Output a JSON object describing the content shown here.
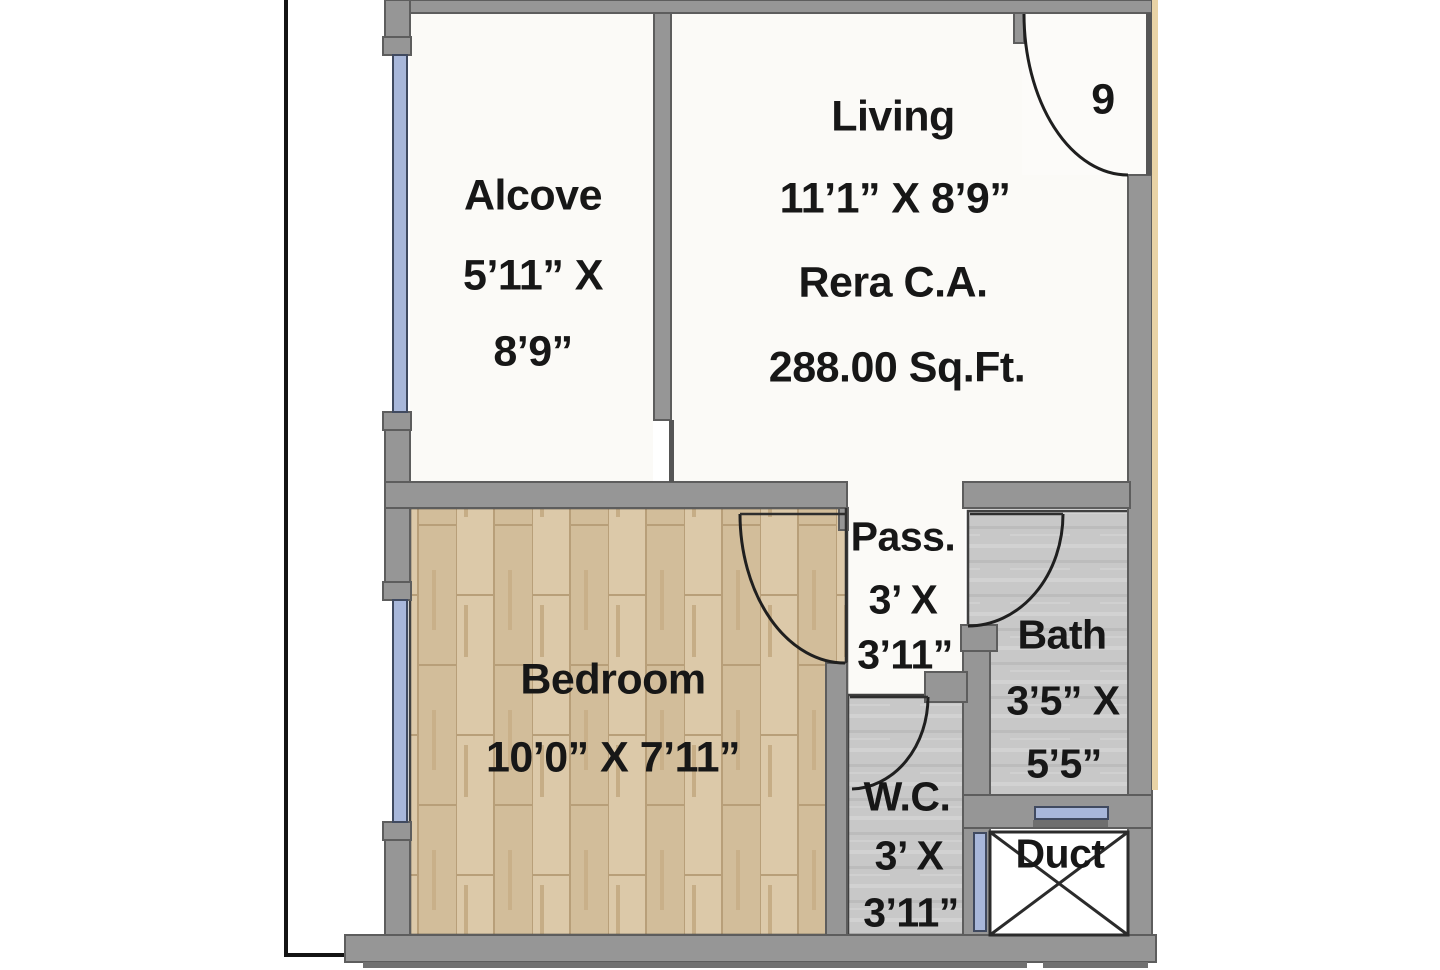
{
  "flat_number": "9",
  "rooms": {
    "alcove": {
      "name": "Alcove",
      "dim1": "5’11” X",
      "dim2": "8’9”"
    },
    "living": {
      "name": "Living",
      "dim": "11’1” X 8’9”",
      "rera": "Rera C.A.",
      "area": "288.00 Sq.Ft."
    },
    "bedroom": {
      "name": "Bedroom",
      "dim": "10’0” X 7’11”"
    },
    "pass": {
      "name": "Pass.",
      "dim1": "3’ X",
      "dim2": "3’11”"
    },
    "bath": {
      "name": "Bath",
      "dim1": "3’5” X",
      "dim2": "5’5”"
    },
    "wc": {
      "name": "W.C.",
      "dim1": "3’ X",
      "dim2": "3’11”"
    },
    "duct": {
      "name": "Duct"
    }
  },
  "colors": {
    "wall": "#969696",
    "wall_edge": "#5d5d5d",
    "window": "#a8b7da",
    "window_edge": "#404a60",
    "wood_floor": "#d7c2a0",
    "tile_floor": "#c8c8c8",
    "white_floor": "#fbfaf7",
    "text": "#171717",
    "outline_black": "#141414",
    "accent_strip": "#e9d3a6"
  }
}
